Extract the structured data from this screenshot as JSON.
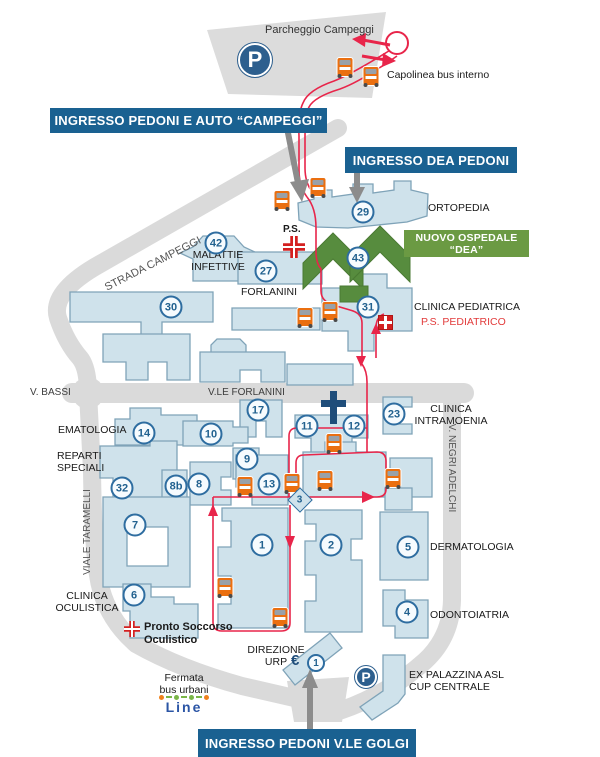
{
  "banners": {
    "campeggi": "INGRESSO PEDONI E AUTO “CAMPEGGI”",
    "dea": "INGRESSO DEA PEDONI",
    "golgi": "INGRESSO PEDONI V.LE GOLGI"
  },
  "green_banner": "NUOVO OSPEDALE “DEA”",
  "parking": {
    "label": "Parcheggio Campeggi",
    "symbol": "P"
  },
  "bus_terminal": {
    "capolinea": "Capolinea bus interno",
    "fermata": "Fermata\nbus urbani",
    "line_logo": "Line"
  },
  "colors": {
    "banner_blue": "#1a6191",
    "banner_green": "#6b9a43",
    "building_green": "#578c3e",
    "building_fill": "#cfe2eb",
    "building_stroke": "#7fa3b8",
    "road_grey": "#dadada",
    "route_red": "#e8254a",
    "bus_orange": "#ea6f10",
    "navy": "#1f4d7a",
    "ps_red": "#d42020"
  },
  "labels": [
    {
      "text": "Parcheggio Campeggi",
      "x": 265,
      "y": 24,
      "size": 11,
      "color": "#333333"
    },
    {
      "text": "Capolinea bus interno",
      "x": 387,
      "y": 69,
      "size": 10.5
    },
    {
      "text": "ORTOPEDIA",
      "x": 428,
      "y": 202,
      "size": 10.5
    },
    {
      "text": "STRADA CAMPEGGI",
      "x": 100,
      "y": 258,
      "size": 11,
      "color": "#565656",
      "rotate": -27
    },
    {
      "text": "P.S.",
      "x": 283,
      "y": 224,
      "size": 10,
      "weight": 700
    },
    {
      "text": "MALATTIE\nINFETTIVE",
      "x": 180,
      "y": 249,
      "w": 76,
      "align": "center",
      "size": 10.5
    },
    {
      "text": "FORLANINI",
      "x": 241,
      "y": 286,
      "size": 10.5
    },
    {
      "text": "CLINICA PEDIATRICA",
      "x": 414,
      "y": 301,
      "size": 10.5
    },
    {
      "text": "P.S. PEDIATRICO",
      "x": 421,
      "y": 316,
      "size": 10.5,
      "color": "#e23b3b"
    },
    {
      "text": "V. BASSI",
      "x": 30,
      "y": 387,
      "size": 10,
      "color": "#3c3c3c"
    },
    {
      "text": "V.LE FORLANINI",
      "x": 208,
      "y": 387,
      "size": 10,
      "color": "#3c3c3c"
    },
    {
      "text": "EMATOLOGIA",
      "x": 58,
      "y": 424,
      "size": 10.5
    },
    {
      "text": "CLINICA\nINTRAMOENIA",
      "x": 410,
      "y": 403,
      "w": 82,
      "align": "center",
      "size": 10.5
    },
    {
      "text": "REPARTI\nSPECIALI",
      "x": 57,
      "y": 450,
      "size": 10.5
    },
    {
      "text": "V. NEGRI ADELCHI",
      "x": 451,
      "y": 468,
      "size": 10,
      "color": "#555555",
      "rotate": 90,
      "center": true
    },
    {
      "text": "VIALE TARAMELLI",
      "x": 88,
      "y": 532,
      "size": 10,
      "color": "#555555",
      "rotate": -90,
      "center": true
    },
    {
      "text": "DERMATOLOGIA",
      "x": 430,
      "y": 541,
      "size": 10.5
    },
    {
      "text": "CLINICA\nOCULISTICA",
      "x": 50,
      "y": 590,
      "w": 74,
      "align": "center",
      "size": 10.5
    },
    {
      "text": "Pronto Soccorso\nOculistico",
      "x": 144,
      "y": 621,
      "size": 11,
      "weight": 700
    },
    {
      "text": "ODONTOIATRIA",
      "x": 430,
      "y": 609,
      "size": 10.5
    },
    {
      "text": "DIREZIONE\nURP",
      "x": 245,
      "y": 644,
      "w": 62,
      "align": "center",
      "size": 10.5
    },
    {
      "text": "€",
      "x": 291,
      "y": 652,
      "size": 15,
      "weight": 700,
      "color": "#1f4d7a"
    },
    {
      "text": "EX PALAZZINA ASL\nCUP CENTRALE",
      "x": 409,
      "y": 669,
      "size": 10.5
    },
    {
      "text": "Fermata\nbus urbani",
      "x": 146,
      "y": 672,
      "w": 76,
      "align": "center",
      "size": 10.5
    }
  ],
  "markers": [
    {
      "n": "42",
      "x": 216,
      "y": 243
    },
    {
      "n": "29",
      "x": 363,
      "y": 212
    },
    {
      "n": "43",
      "x": 358,
      "y": 258
    },
    {
      "n": "27",
      "x": 266,
      "y": 271
    },
    {
      "n": "30",
      "x": 171,
      "y": 307
    },
    {
      "n": "31",
      "x": 368,
      "y": 307
    },
    {
      "n": "17",
      "x": 258,
      "y": 410
    },
    {
      "n": "14",
      "x": 144,
      "y": 433
    },
    {
      "n": "10",
      "x": 211,
      "y": 434
    },
    {
      "n": "11",
      "x": 307,
      "y": 426
    },
    {
      "n": "12",
      "x": 354,
      "y": 426
    },
    {
      "n": "23",
      "x": 394,
      "y": 414
    },
    {
      "n": "9",
      "x": 247,
      "y": 459
    },
    {
      "n": "32",
      "x": 122,
      "y": 488
    },
    {
      "n": "8b",
      "x": 176,
      "y": 486
    },
    {
      "n": "8",
      "x": 199,
      "y": 484
    },
    {
      "n": "13",
      "x": 269,
      "y": 484
    },
    {
      "n": "7",
      "x": 135,
      "y": 525
    },
    {
      "n": "1",
      "x": 262,
      "y": 545
    },
    {
      "n": "2",
      "x": 331,
      "y": 545
    },
    {
      "n": "5",
      "x": 408,
      "y": 547
    },
    {
      "n": "6",
      "x": 134,
      "y": 595
    },
    {
      "n": "4",
      "x": 407,
      "y": 612
    }
  ],
  "diamond_marker": {
    "n": "3"
  },
  "urp_marker": {
    "n": "1"
  },
  "buses": [
    {
      "x": 345,
      "y": 67
    },
    {
      "x": 371,
      "y": 76
    },
    {
      "x": 318,
      "y": 187
    },
    {
      "x": 282,
      "y": 200
    },
    {
      "x": 305,
      "y": 317
    },
    {
      "x": 330,
      "y": 311
    },
    {
      "x": 334,
      "y": 443
    },
    {
      "x": 245,
      "y": 486
    },
    {
      "x": 292,
      "y": 483
    },
    {
      "x": 325,
      "y": 480
    },
    {
      "x": 393,
      "y": 478
    },
    {
      "x": 225,
      "y": 587
    },
    {
      "x": 280,
      "y": 617
    }
  ],
  "crosses": [
    {
      "x": 283,
      "y": 236,
      "d": 22,
      "cls": "cross-plus"
    },
    {
      "x": 378,
      "y": 315,
      "d": 15,
      "cls": "cross-box"
    },
    {
      "x": 124,
      "y": 621,
      "d": 16,
      "cls": "cross-plus"
    }
  ]
}
